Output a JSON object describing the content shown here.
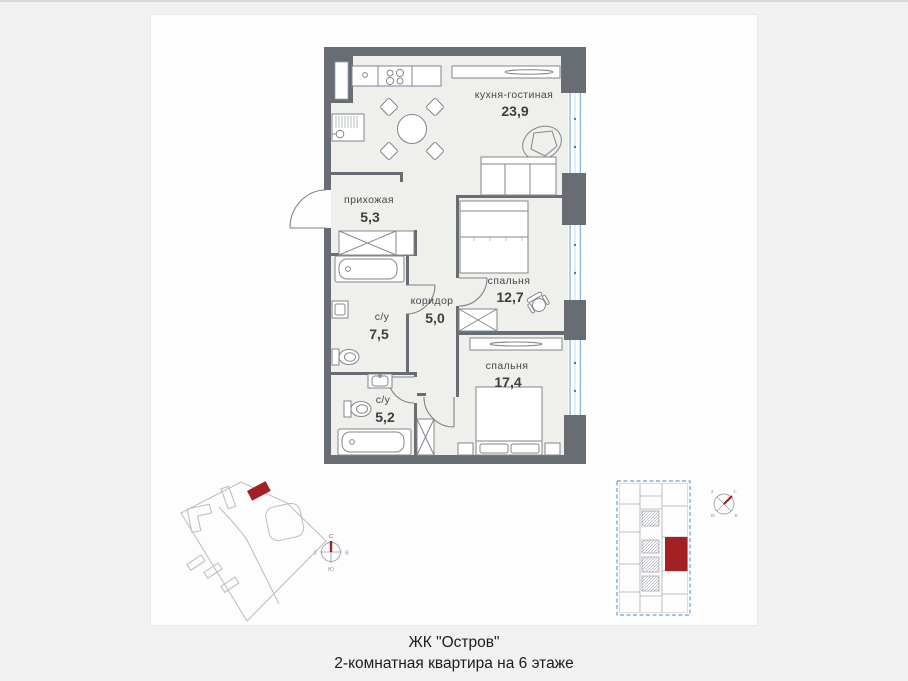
{
  "caption": {
    "line1": "ЖК \"Остров\"",
    "line2": "2-комнатная квартира на 6 этаже"
  },
  "plan": {
    "rooms": {
      "kitchen_living": {
        "label": "кухня-гостиная",
        "area": "23,9"
      },
      "hallway": {
        "label": "прихожая",
        "area": "5,3"
      },
      "bedroom_1": {
        "label": "спальня",
        "area": "12,7"
      },
      "corridor": {
        "label": "коридор",
        "area": "5,0"
      },
      "bathroom_1": {
        "label": "с/у",
        "area": "7,5"
      },
      "bedroom_2": {
        "label": "спальня",
        "area": "17,4"
      },
      "bathroom_2": {
        "label": "с/у",
        "area": "5,2"
      }
    }
  },
  "compass": {
    "north": "С",
    "south": "Ю",
    "west": "З",
    "east": "В"
  },
  "colors": {
    "wall": "#676d73",
    "highlight_red": "#a32024",
    "window_blue": "#8fb9d6",
    "floor": "#efefec"
  }
}
